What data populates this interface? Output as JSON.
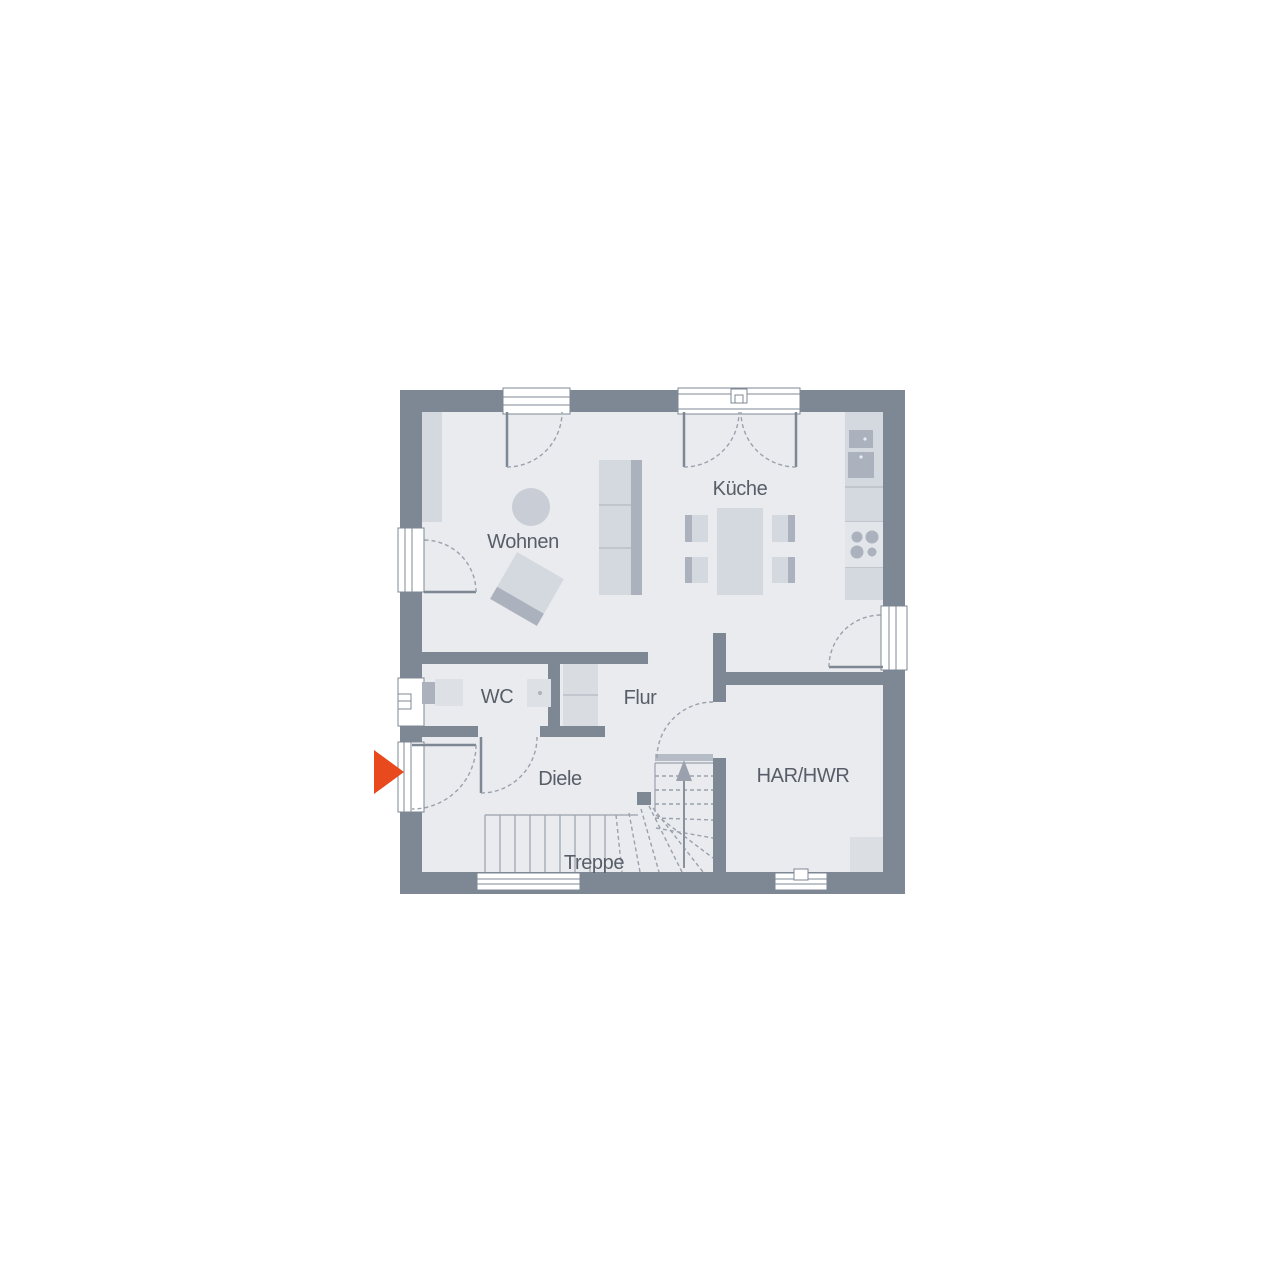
{
  "plan": {
    "kind": "residential ground-floor plan",
    "rooms": [
      {
        "name": "wohnen",
        "label": "Wohnen"
      },
      {
        "name": "kueche",
        "label": "Küche"
      },
      {
        "name": "wc",
        "label": "WC"
      },
      {
        "name": "flur",
        "label": "Flur"
      },
      {
        "name": "diele",
        "label": "Diele"
      },
      {
        "name": "har-hwr",
        "label": "HAR/HWR"
      },
      {
        "name": "treppe",
        "label": "Treppe"
      }
    ],
    "icons": [
      {
        "name": "entrance-arrow-icon",
        "meaning": "main entrance direction marker",
        "color": "#E8491D"
      },
      {
        "name": "stairs-up-arrow-icon",
        "meaning": "stair ascending direction"
      }
    ]
  },
  "colors": {
    "background": "#FFFFFF",
    "wall": "#7E8895",
    "floor": "#E9EBEF",
    "furniture_light": "#D4D8DF",
    "furniture_dark": "#ACB2BD",
    "window_frame_fill": "#FFFFFF",
    "line": "#9AA1AC",
    "label_text": "#585E68",
    "entrance_arrow": "#E8491D"
  }
}
